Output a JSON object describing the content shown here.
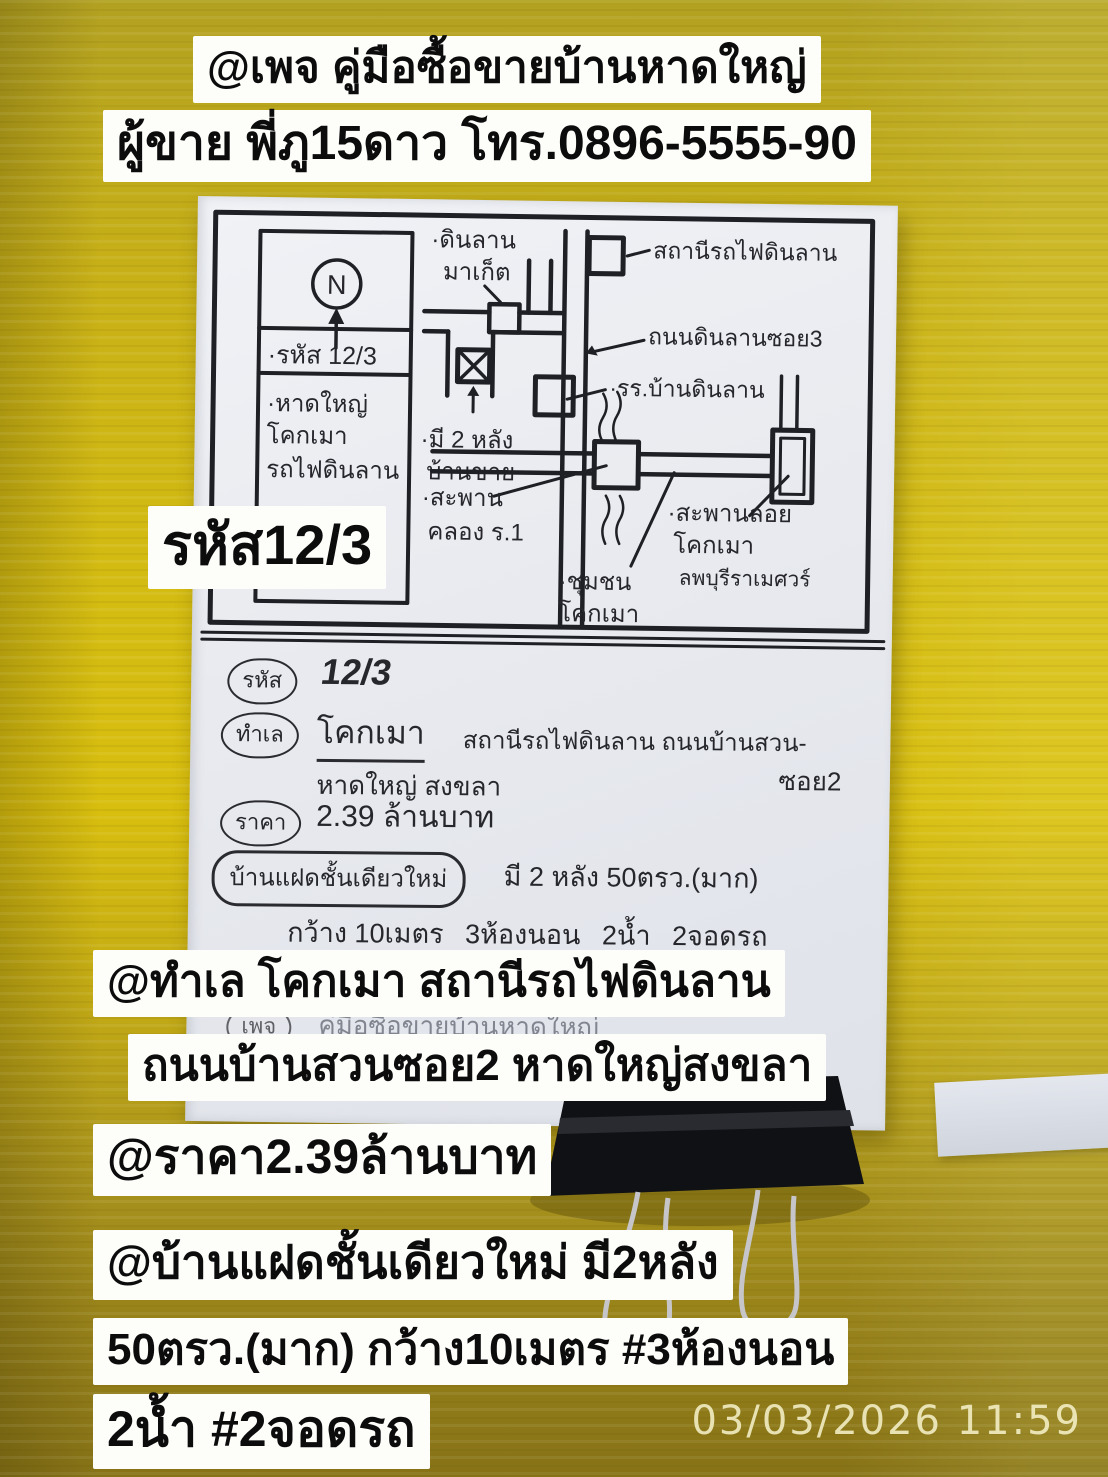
{
  "captions": {
    "page_line": "@เพจ คู่มือซื้อขายบ้านหาดใหญ่",
    "seller_line": "ผู้ขาย พี่ภู15ดาว โทร.0896-5555-90",
    "code_badge": "รหัส12/3",
    "location_line1": "@ทำเล โคกเมา สถานีรถไฟดินลาน",
    "location_line2": "ถนนบ้านสวนซอย2 หาดใหญ่สงขลา",
    "price_line": "@ราคา2.39ล้านบาท",
    "house_line1": "@บ้านแฝดชั้นเดียวใหม่ มี2หลัง",
    "house_line2": "50ตรว.(มาก) กว้าง10เมตร #3ห้องนอน",
    "house_line3": "2น้ำ #2จอดรถ"
  },
  "timestamp": "03/03/2026 11:59",
  "map": {
    "compass_letter": "N",
    "labels": {
      "code": "·รหัส 12/3",
      "area1": "·หาดใหญ่",
      "area2": "โคกเมา",
      "area3": "รถไฟดินลาน",
      "market1": "·ดินลาน",
      "market2": "มาเก็ต",
      "station": "สถานีรถไฟดินลาน",
      "road_soi3": "ถนนดินลานซอย3",
      "school": "·รร.บ้านดินลาน",
      "house1": "·มี 2 หลัง",
      "house2": "บ้านขาย",
      "bridge1": "·สะพาน",
      "bridge2": "คลอง ร.1",
      "community1": "·ชุมชน",
      "community2": "โคกเมา",
      "overpass1": "·สะพานลอย",
      "overpass2": "โคกเมา",
      "overpass3": "ลพบุรีราเมศวร์"
    }
  },
  "notes": {
    "code_label": "รหัส",
    "code_value": "12/3",
    "location_label": "ทำเล",
    "location_value_main": "โคกเมา",
    "location_value_rest": "สถานีรถไฟดินลาน ถนนบ้านสวน-",
    "location_value_soi": "ซอย2",
    "location_value_line2": "หาดใหญ่ สงขลา",
    "price_label": "ราคา",
    "price_value": "2.39 ล้านบาท",
    "house_label": "บ้านแฝดชั้นเดียวใหม่",
    "house_value": "มี 2 หลัง 50ตรว.(มาก)",
    "house_detail_1": "กว้าง 10เมตร",
    "house_detail_2": "3ห้องนอน",
    "house_detail_3": "2น้ำ",
    "house_detail_4": "2จอดรถ",
    "page_label": "เพจ",
    "page_value": "คู่มือซื้อขายบ้านหาดใหญ่"
  },
  "colors": {
    "background_yellow": "#d3bb12",
    "background_olive_bottom": "#877317",
    "paper": "#e9ebf0",
    "ink": "#26262c",
    "caption_bg": "#fdfdfa",
    "caption_text": "#0c0c0d",
    "timestamp_text": "#f5f0c8"
  }
}
